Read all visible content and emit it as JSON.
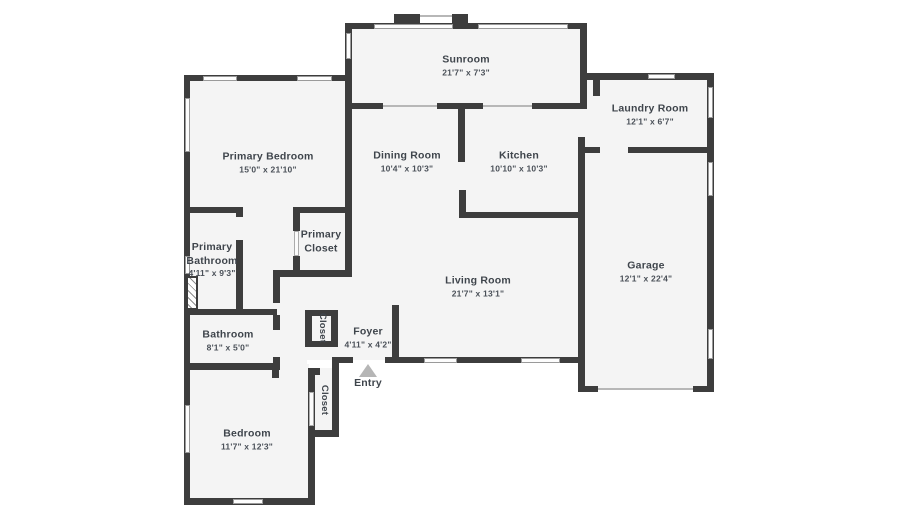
{
  "colors": {
    "wall": "#3d3d3d",
    "floor": "#f4f4f4",
    "window_border": "#9a9a9a",
    "label_text": "#3f454c",
    "entry_arrow": "#b6b6b6"
  },
  "rooms": [
    {
      "name": "Sunroom",
      "dims": "21'7\" x 7'3\""
    },
    {
      "name": "Laundry Room",
      "dims": "12'1\" x 6'7\""
    },
    {
      "name": "Primary Bedroom",
      "dims": "15'0\" x 21'10\""
    },
    {
      "name": "Dining Room",
      "dims": "10'4\" x 10'3\""
    },
    {
      "name": "Kitchen",
      "dims": "10'10\" x 10'3\""
    },
    {
      "name": "Primary Bathroom",
      "dims": "4'11\" x 9'3\""
    },
    {
      "name": "Primary Closet",
      "dims": ""
    },
    {
      "name": "Garage",
      "dims": "12'1\" x 22'4\""
    },
    {
      "name": "Living Room",
      "dims": "21'7\" x 13'1\""
    },
    {
      "name": "Bathroom",
      "dims": "8'1\" x 5'0\""
    },
    {
      "name": "Closet",
      "dims": ""
    },
    {
      "name": "Foyer",
      "dims": "4'11\" x 4'2\""
    },
    {
      "name": "Entry",
      "dims": ""
    },
    {
      "name": "Closet",
      "dims": ""
    },
    {
      "name": "Bedroom",
      "dims": "11'7\" x 12'3\""
    }
  ]
}
